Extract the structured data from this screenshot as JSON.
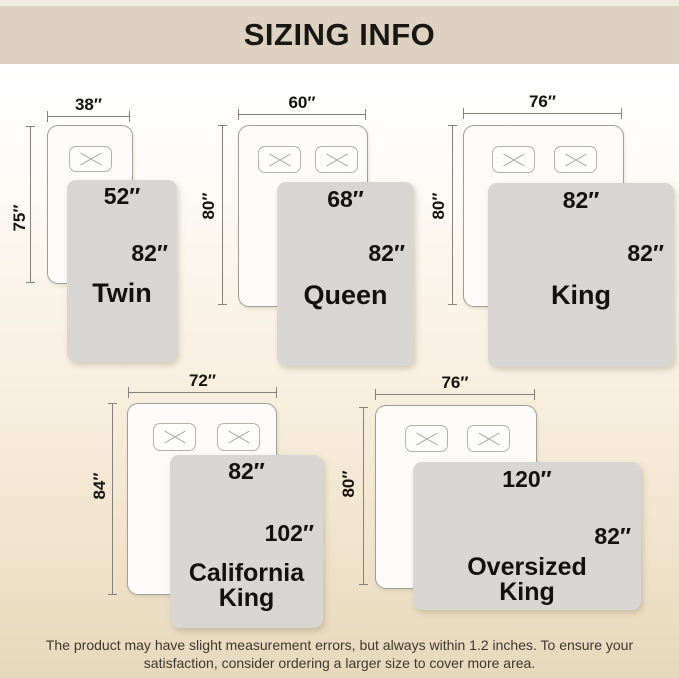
{
  "header": {
    "title": "SIZING INFO"
  },
  "sizes": [
    {
      "name": "Twin",
      "mattress": {
        "width": "38″",
        "length": "75″"
      },
      "blanket": {
        "width": "52″",
        "length": "82″"
      },
      "pillows": 1
    },
    {
      "name": "Queen",
      "mattress": {
        "width": "60″",
        "length": "80″"
      },
      "blanket": {
        "width": "68″",
        "length": "82″"
      },
      "pillows": 2
    },
    {
      "name": "King",
      "mattress": {
        "width": "76″",
        "length": "80″"
      },
      "blanket": {
        "width": "82″",
        "length": "82″"
      },
      "pillows": 2
    },
    {
      "name": "California King",
      "name_lines": [
        "California",
        "King"
      ],
      "mattress": {
        "width": "72″",
        "length": "84″"
      },
      "blanket": {
        "width": "82″",
        "length": "102″"
      },
      "pillows": 2
    },
    {
      "name": "Oversized King",
      "name_lines": [
        "Oversized",
        "King"
      ],
      "mattress": {
        "width": "76″",
        "length": "80″"
      },
      "blanket": {
        "width": "120″",
        "length": "82″"
      },
      "pillows": 2
    }
  ],
  "footer": {
    "line1": "The product may have slight measurement errors, but always within 1.2 inches. To ensure your",
    "line2": "satisfaction, consider ordering a larger size to cover more area."
  },
  "colors": {
    "header_bg": "#ddd2c1",
    "blanket": "#d7d6d3",
    "background_bottom": "#e7d8bc"
  }
}
